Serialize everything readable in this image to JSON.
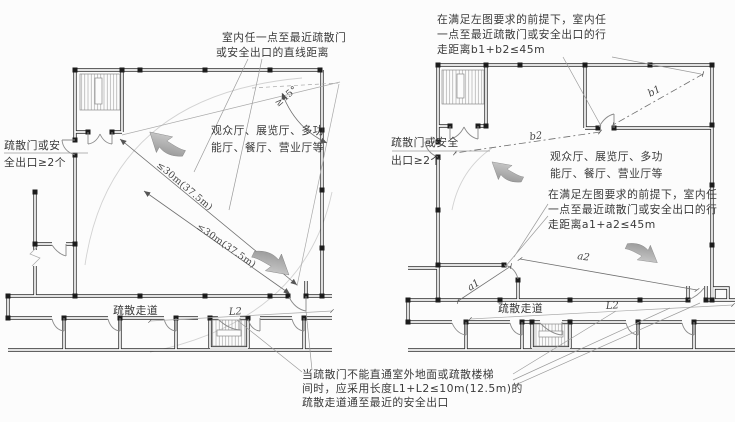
{
  "palette": {
    "wall": "#2e2e2e",
    "column": "#1c1c1c",
    "arrow_dark": "#848484",
    "arrow_light": "#dadada",
    "text": "#3a3a3a",
    "construction_line": "#a9a9a9"
  },
  "left_plan": {
    "top_note": [
      "室内任一点至最近疏散门",
      "或安全出口的直线距离"
    ],
    "exit_note": [
      "疏散门或安",
      "全出口≥2个"
    ],
    "room_label": [
      "观众厅、展览厅、多功",
      "能厅、餐厅、营业厅等"
    ],
    "dist1": "≤30m(37.5m)",
    "dist2": "≤30m(37.5m)",
    "angle": "≥45°",
    "corridor": "疏散走道",
    "l2": "L2"
  },
  "right_plan": {
    "top_note": [
      "在满足左图要求的前提下，室内任",
      "一点至最近疏散门或安全出口的行",
      "走距离b1+b2≤45m"
    ],
    "exit_note": [
      "疏散门或安全",
      "出口≥2个"
    ],
    "room_label": [
      "观众厅、展览厅、多功",
      "能厅、餐厅、营业厅等"
    ],
    "mid_note": [
      "在满足左图要求的前提下，室内任",
      "一点至最近疏散门或安全出口的行",
      "走距离a1+a2≤45m"
    ],
    "b1": "b1",
    "b2": "b2",
    "a1": "a1",
    "a2": "a2",
    "corridor": "疏散走道",
    "l2": "L2"
  },
  "bottom_note": [
    "当疏散门不能直通室外地面或疏散楼梯",
    "间时，应采用长度L1+L2≤10m(12.5m)的",
    "疏散走道通至最近的安全出口"
  ]
}
